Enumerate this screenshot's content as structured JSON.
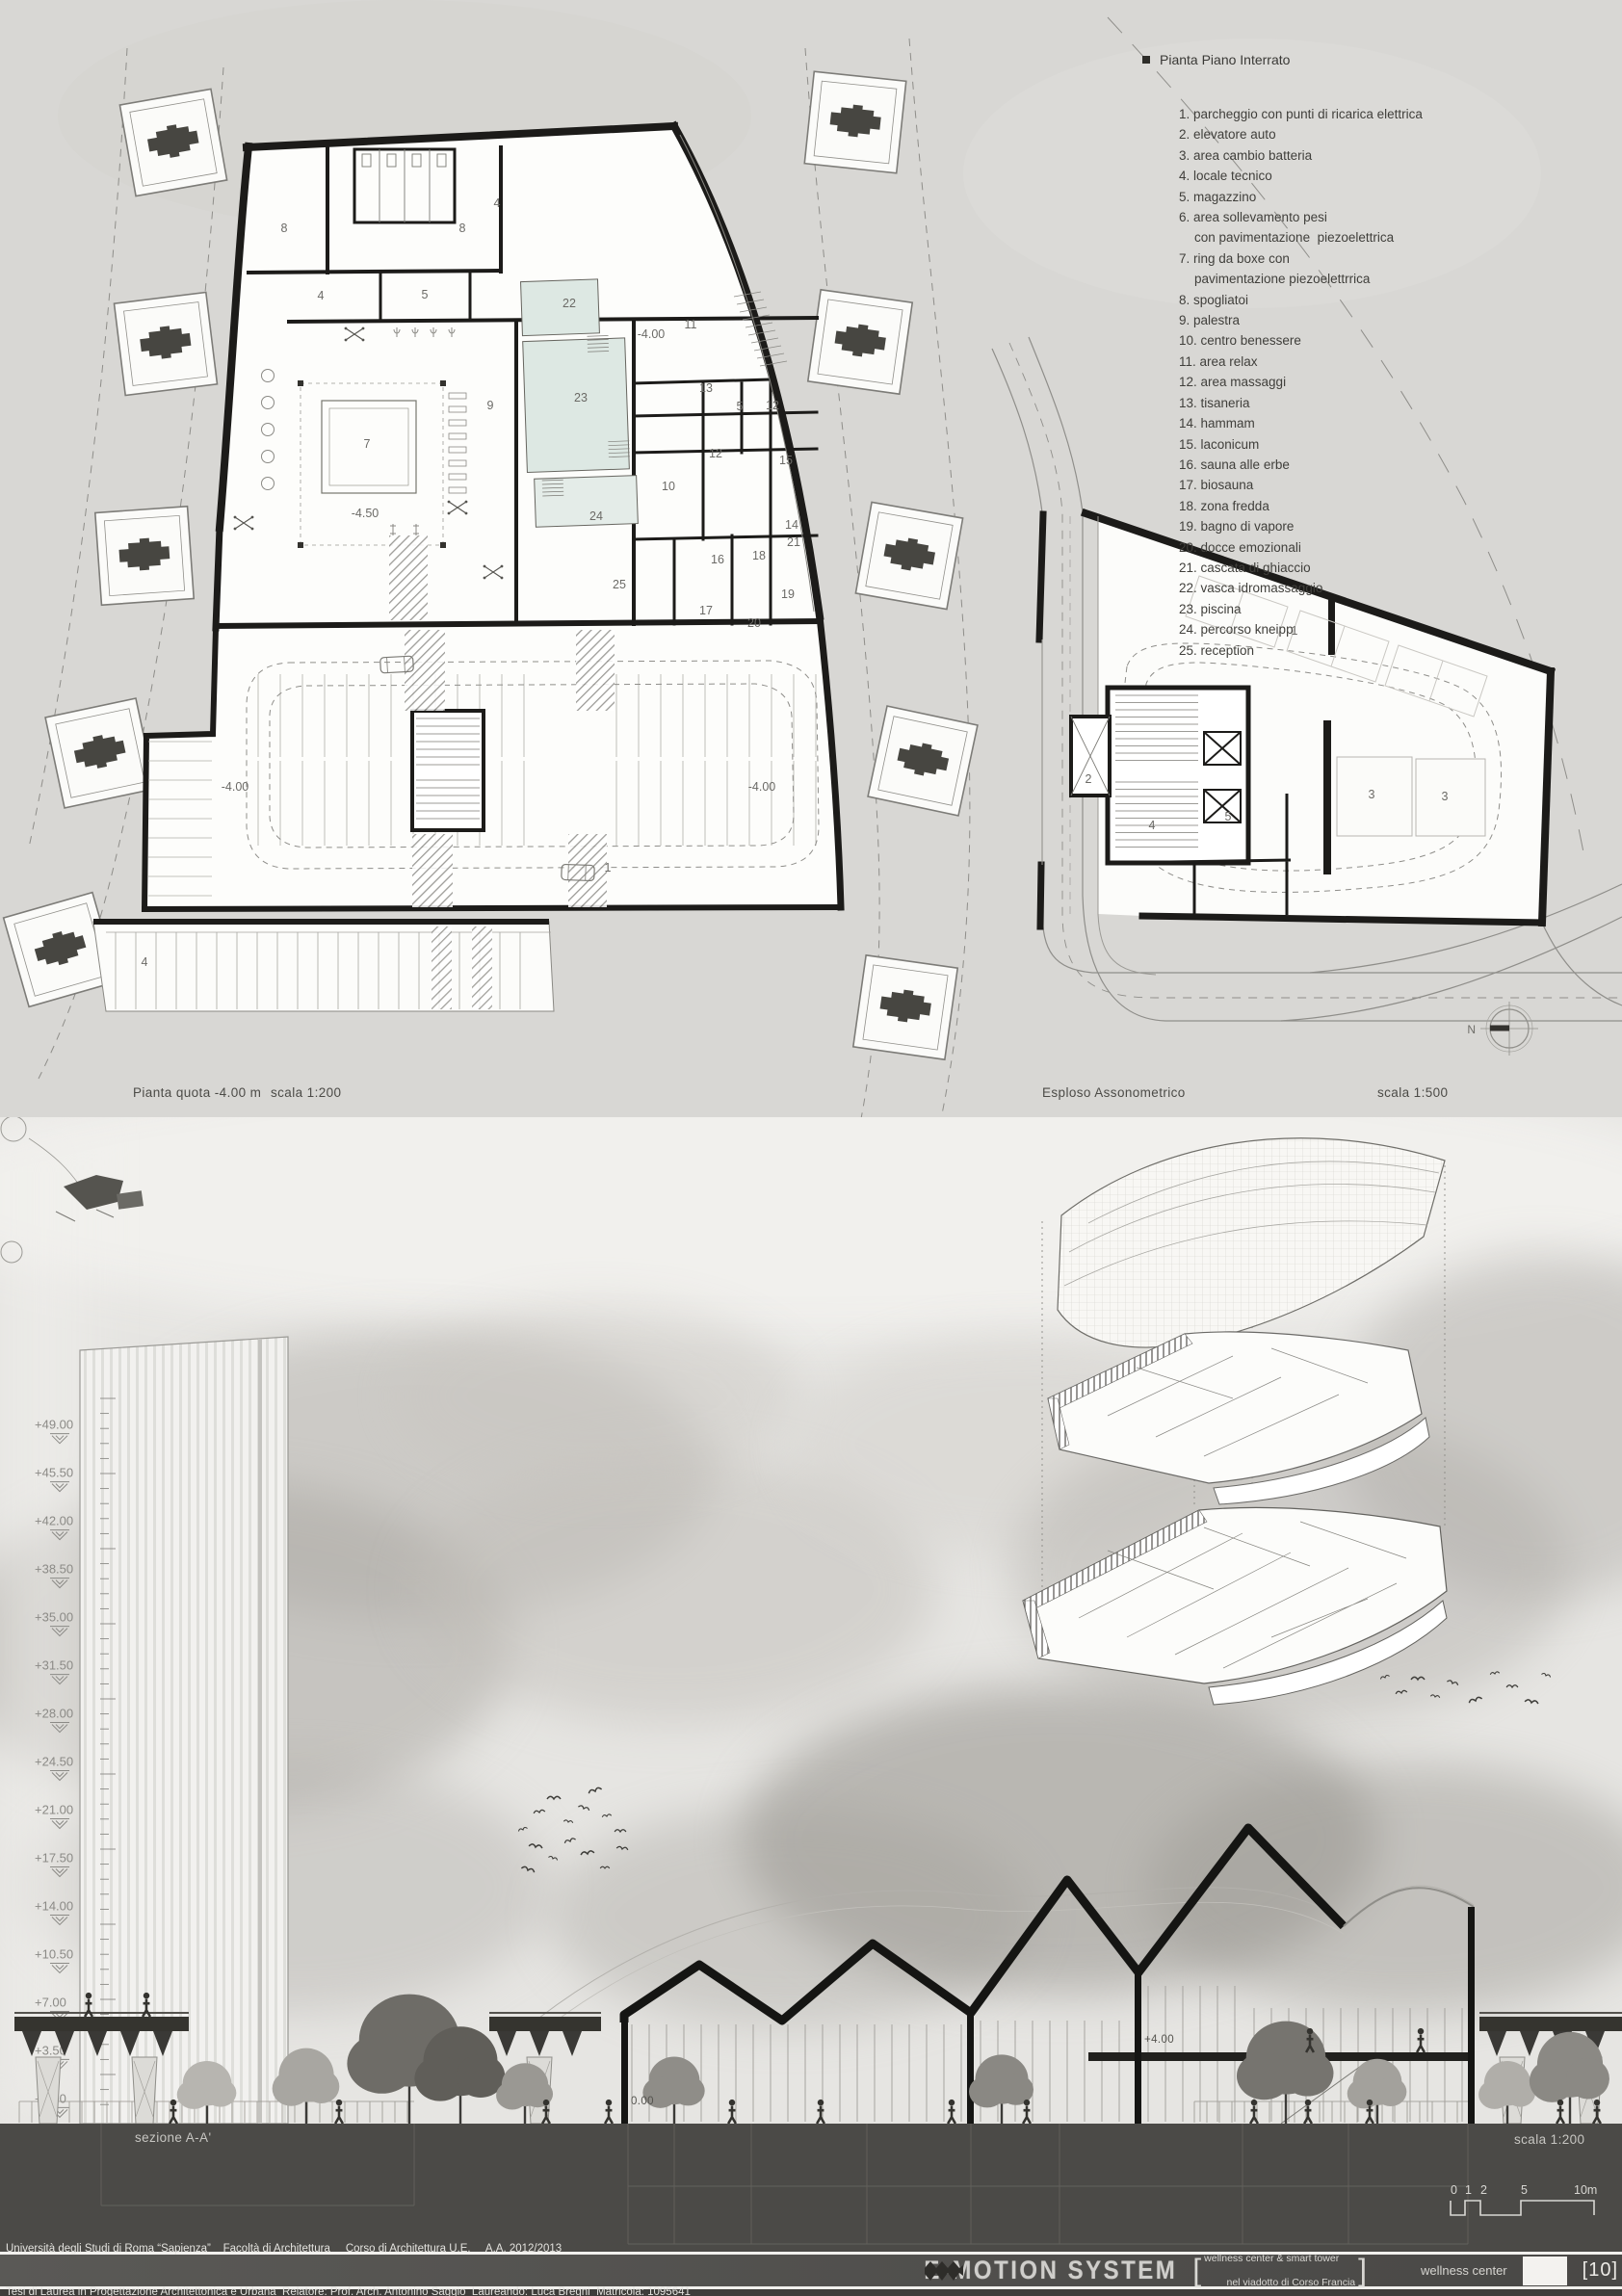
{
  "colors": {
    "ink": "#1c1b19",
    "pool": "#dde8e3",
    "ground": "#4b4a47",
    "paper": "#d8d7d4"
  },
  "legend": {
    "title": "Pianta Piano Interrato",
    "items": [
      {
        "n": "1.",
        "t": "parcheggio con punti di ricarica elettrica"
      },
      {
        "n": "2.",
        "t": "elevatore auto"
      },
      {
        "n": "3.",
        "t": "area cambio batteria"
      },
      {
        "n": "4.",
        "t": "locale tecnico"
      },
      {
        "n": "5.",
        "t": "magazzino"
      },
      {
        "n": "6.",
        "t": "area sollevamento pesi",
        "t2": "con pavimentazione  piezoelettrica"
      },
      {
        "n": "7.",
        "t": "ring da boxe con",
        "t2": "pavimentazione piezoelettrrica"
      },
      {
        "n": "8.",
        "t": "spogliatoi"
      },
      {
        "n": "9.",
        "t": "palestra"
      },
      {
        "n": "10.",
        "t": "centro benessere"
      },
      {
        "n": "11.",
        "t": "area relax"
      },
      {
        "n": "12.",
        "t": "area massaggi"
      },
      {
        "n": "13.",
        "t": "tisaneria"
      },
      {
        "n": "14.",
        "t": "hammam"
      },
      {
        "n": "15.",
        "t": "laconicum"
      },
      {
        "n": "16.",
        "t": "sauna alle erbe"
      },
      {
        "n": "17.",
        "t": "biosauna"
      },
      {
        "n": "18.",
        "t": "zona fredda"
      },
      {
        "n": "19.",
        "t": "bagno di vapore"
      },
      {
        "n": "20.",
        "t": "docce emozionali"
      },
      {
        "n": "21.",
        "t": "cascata di ghiaccio"
      },
      {
        "n": "22.",
        "t": "vasca idromassaggio"
      },
      {
        "n": "23.",
        "t": "piscina"
      },
      {
        "n": "24.",
        "t": "percorso kneipp"
      },
      {
        "n": "25.",
        "t": "reception"
      }
    ]
  },
  "captions": {
    "plan_title": "Pianta quota -4.00 m",
    "plan_scale": "scala 1:200",
    "axo_title": "Esploso Assonometrico",
    "axo_scale": "scala 1:500",
    "section_title": "sezione A-A'",
    "section_scale": "scala 1:200"
  },
  "compass_label": "N",
  "plan_rooms": [
    [
      "8",
      295,
      241
    ],
    [
      "8",
      480,
      241
    ],
    [
      "4",
      516,
      215
    ],
    [
      "4",
      333,
      311
    ],
    [
      "5",
      441,
      310
    ],
    [
      "9",
      509,
      425
    ],
    [
      "7",
      381,
      465
    ],
    [
      "-4.50",
      379,
      537
    ],
    [
      "22",
      591,
      319
    ],
    [
      "23",
      603,
      417
    ],
    [
      "24",
      619,
      540
    ],
    [
      "-4.00",
      676,
      351
    ],
    [
      "11",
      717,
      341
    ],
    [
      "13",
      733,
      407
    ],
    [
      "5",
      768,
      426
    ],
    [
      "12",
      802,
      425
    ],
    [
      "12",
      743,
      475
    ],
    [
      "15",
      816,
      482
    ],
    [
      "10",
      694,
      509
    ],
    [
      "14",
      822,
      549
    ],
    [
      "21",
      824,
      567
    ],
    [
      "16",
      745,
      585
    ],
    [
      "18",
      788,
      581
    ],
    [
      "17",
      733,
      638
    ],
    [
      "19",
      818,
      621
    ],
    [
      "20",
      783,
      651
    ],
    [
      "25",
      643,
      611
    ],
    [
      "-4.00",
      244,
      821
    ],
    [
      "-4.00",
      791,
      821
    ],
    [
      "1",
      631,
      905
    ],
    [
      "4",
      150,
      1003
    ]
  ],
  "plan2_rooms": [
    [
      "1",
      1344,
      659
    ],
    [
      "2",
      1130,
      813
    ],
    [
      "4",
      1196,
      861
    ],
    [
      "5",
      1275,
      852
    ],
    [
      "3",
      1424,
      829
    ],
    [
      "3",
      1500,
      831
    ]
  ],
  "elevations": [
    "+49.00",
    "+45.50",
    "+42.00",
    "+38.50",
    "+35.00",
    "+31.50",
    "+28.00",
    "+24.50",
    "+21.00",
    "+17.50",
    "+14.00",
    "+10.50",
    "+7.00",
    "+3.50",
    "+0.00"
  ],
  "section_levels": {
    "zero": "0.00",
    "four": "+4.00"
  },
  "scalebar": {
    "labels": [
      [
        "0",
        1506
      ],
      [
        "1",
        1521
      ],
      [
        "2",
        1537
      ],
      [
        "5",
        1579
      ],
      [
        "10m",
        1634
      ]
    ]
  },
  "footer": {
    "line1": "Università degli Studi di Roma “Sapienza”    Facoltà di Architettura     Corso di Architettura U.E.     A.A. 2012/2013",
    "line2": "Tesi di Laurea in Progettazione Architettonica e Urbana  Relatore: Prof. Arch. Antonino Saggio  Laureando: Luca Bregni  Matricola: 1095641",
    "logo": "E-MOTION SYSTEM",
    "sub1": "wellness center & smart tower",
    "sub2": "nel viadotto di Corso Francia",
    "tag": "wellness center",
    "page": "[10]"
  }
}
